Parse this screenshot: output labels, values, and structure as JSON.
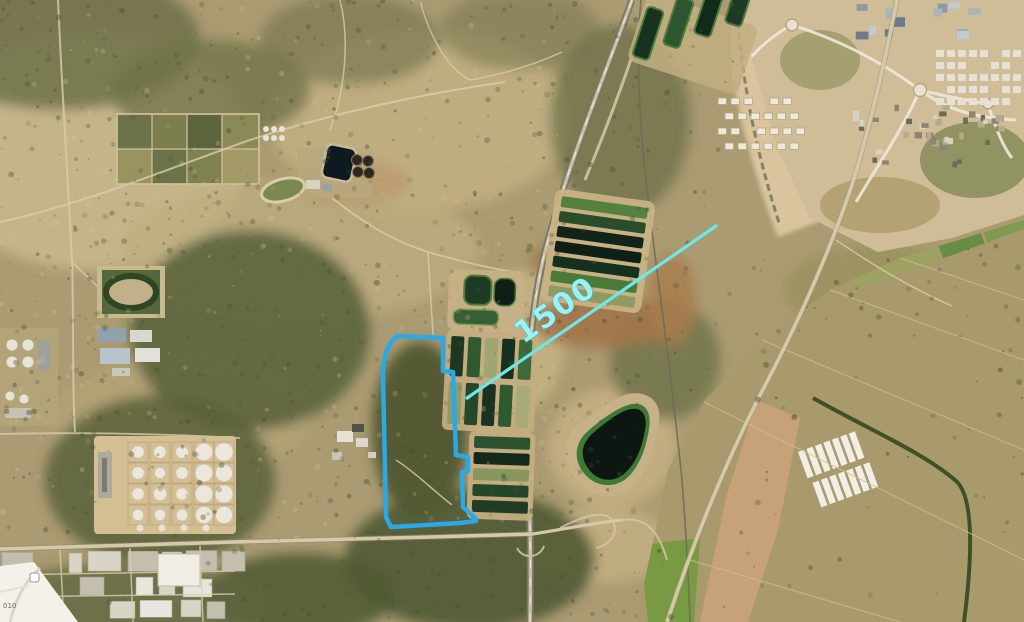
{
  "annotation": {
    "distance_label": "1500",
    "site_outline_color": "#2aa9e6",
    "distance_line_color": "#6ee7ea",
    "label_color": "#9af2f4"
  },
  "map_inset": {
    "label": "010"
  },
  "scene": {
    "description": "Aerial satellite view of semi-arid terrain with a blue site-boundary polygon and a cyan 1500 distance line running northeast toward a town",
    "features": [
      "site-boundary-polygon",
      "distance-line",
      "wastewater-treatment-ponds",
      "dark-reservoir",
      "tank-farm",
      "stadium-track",
      "industrial-zone",
      "town",
      "agricultural-fields",
      "highway",
      "railway"
    ]
  }
}
